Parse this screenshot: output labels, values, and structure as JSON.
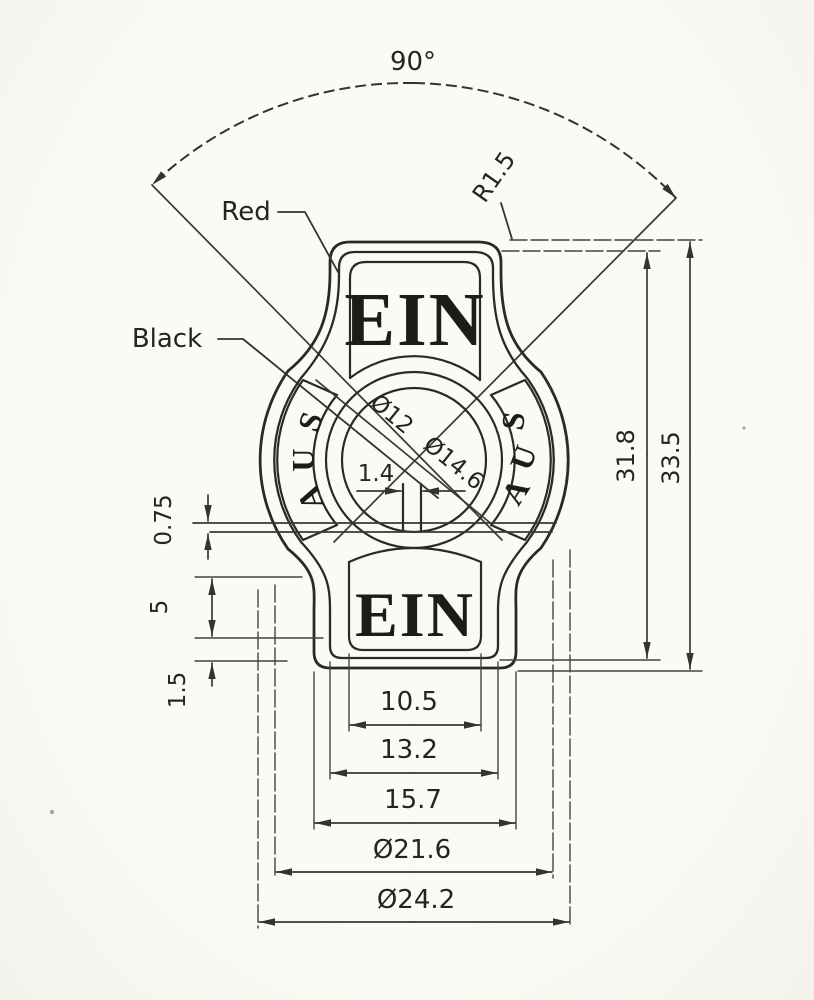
{
  "drawing": {
    "labels": {
      "angle": "90°",
      "corner_radius": "R1.5",
      "red": "Red",
      "black": "Black"
    },
    "switch": {
      "ein_top": "EIN",
      "ein_bottom": "EIN",
      "aus_letters": [
        "A",
        "U",
        "S"
      ]
    },
    "dims": {
      "inner_circle": "Ø12",
      "outer_circle": "Ø14.6",
      "slot": "1.4",
      "step": "0.75",
      "mid": "5",
      "lip": "1.5",
      "width_inner": "10.5",
      "width_mid": "13.2",
      "width_outer": "15.7",
      "body_inner_dia": "Ø21.6",
      "body_outer_dia": "Ø24.2",
      "height_inner": "31.8",
      "height_outer": "33.5"
    },
    "colors": {
      "ink": "#2b2a25",
      "paper": "#faf9f5"
    }
  }
}
